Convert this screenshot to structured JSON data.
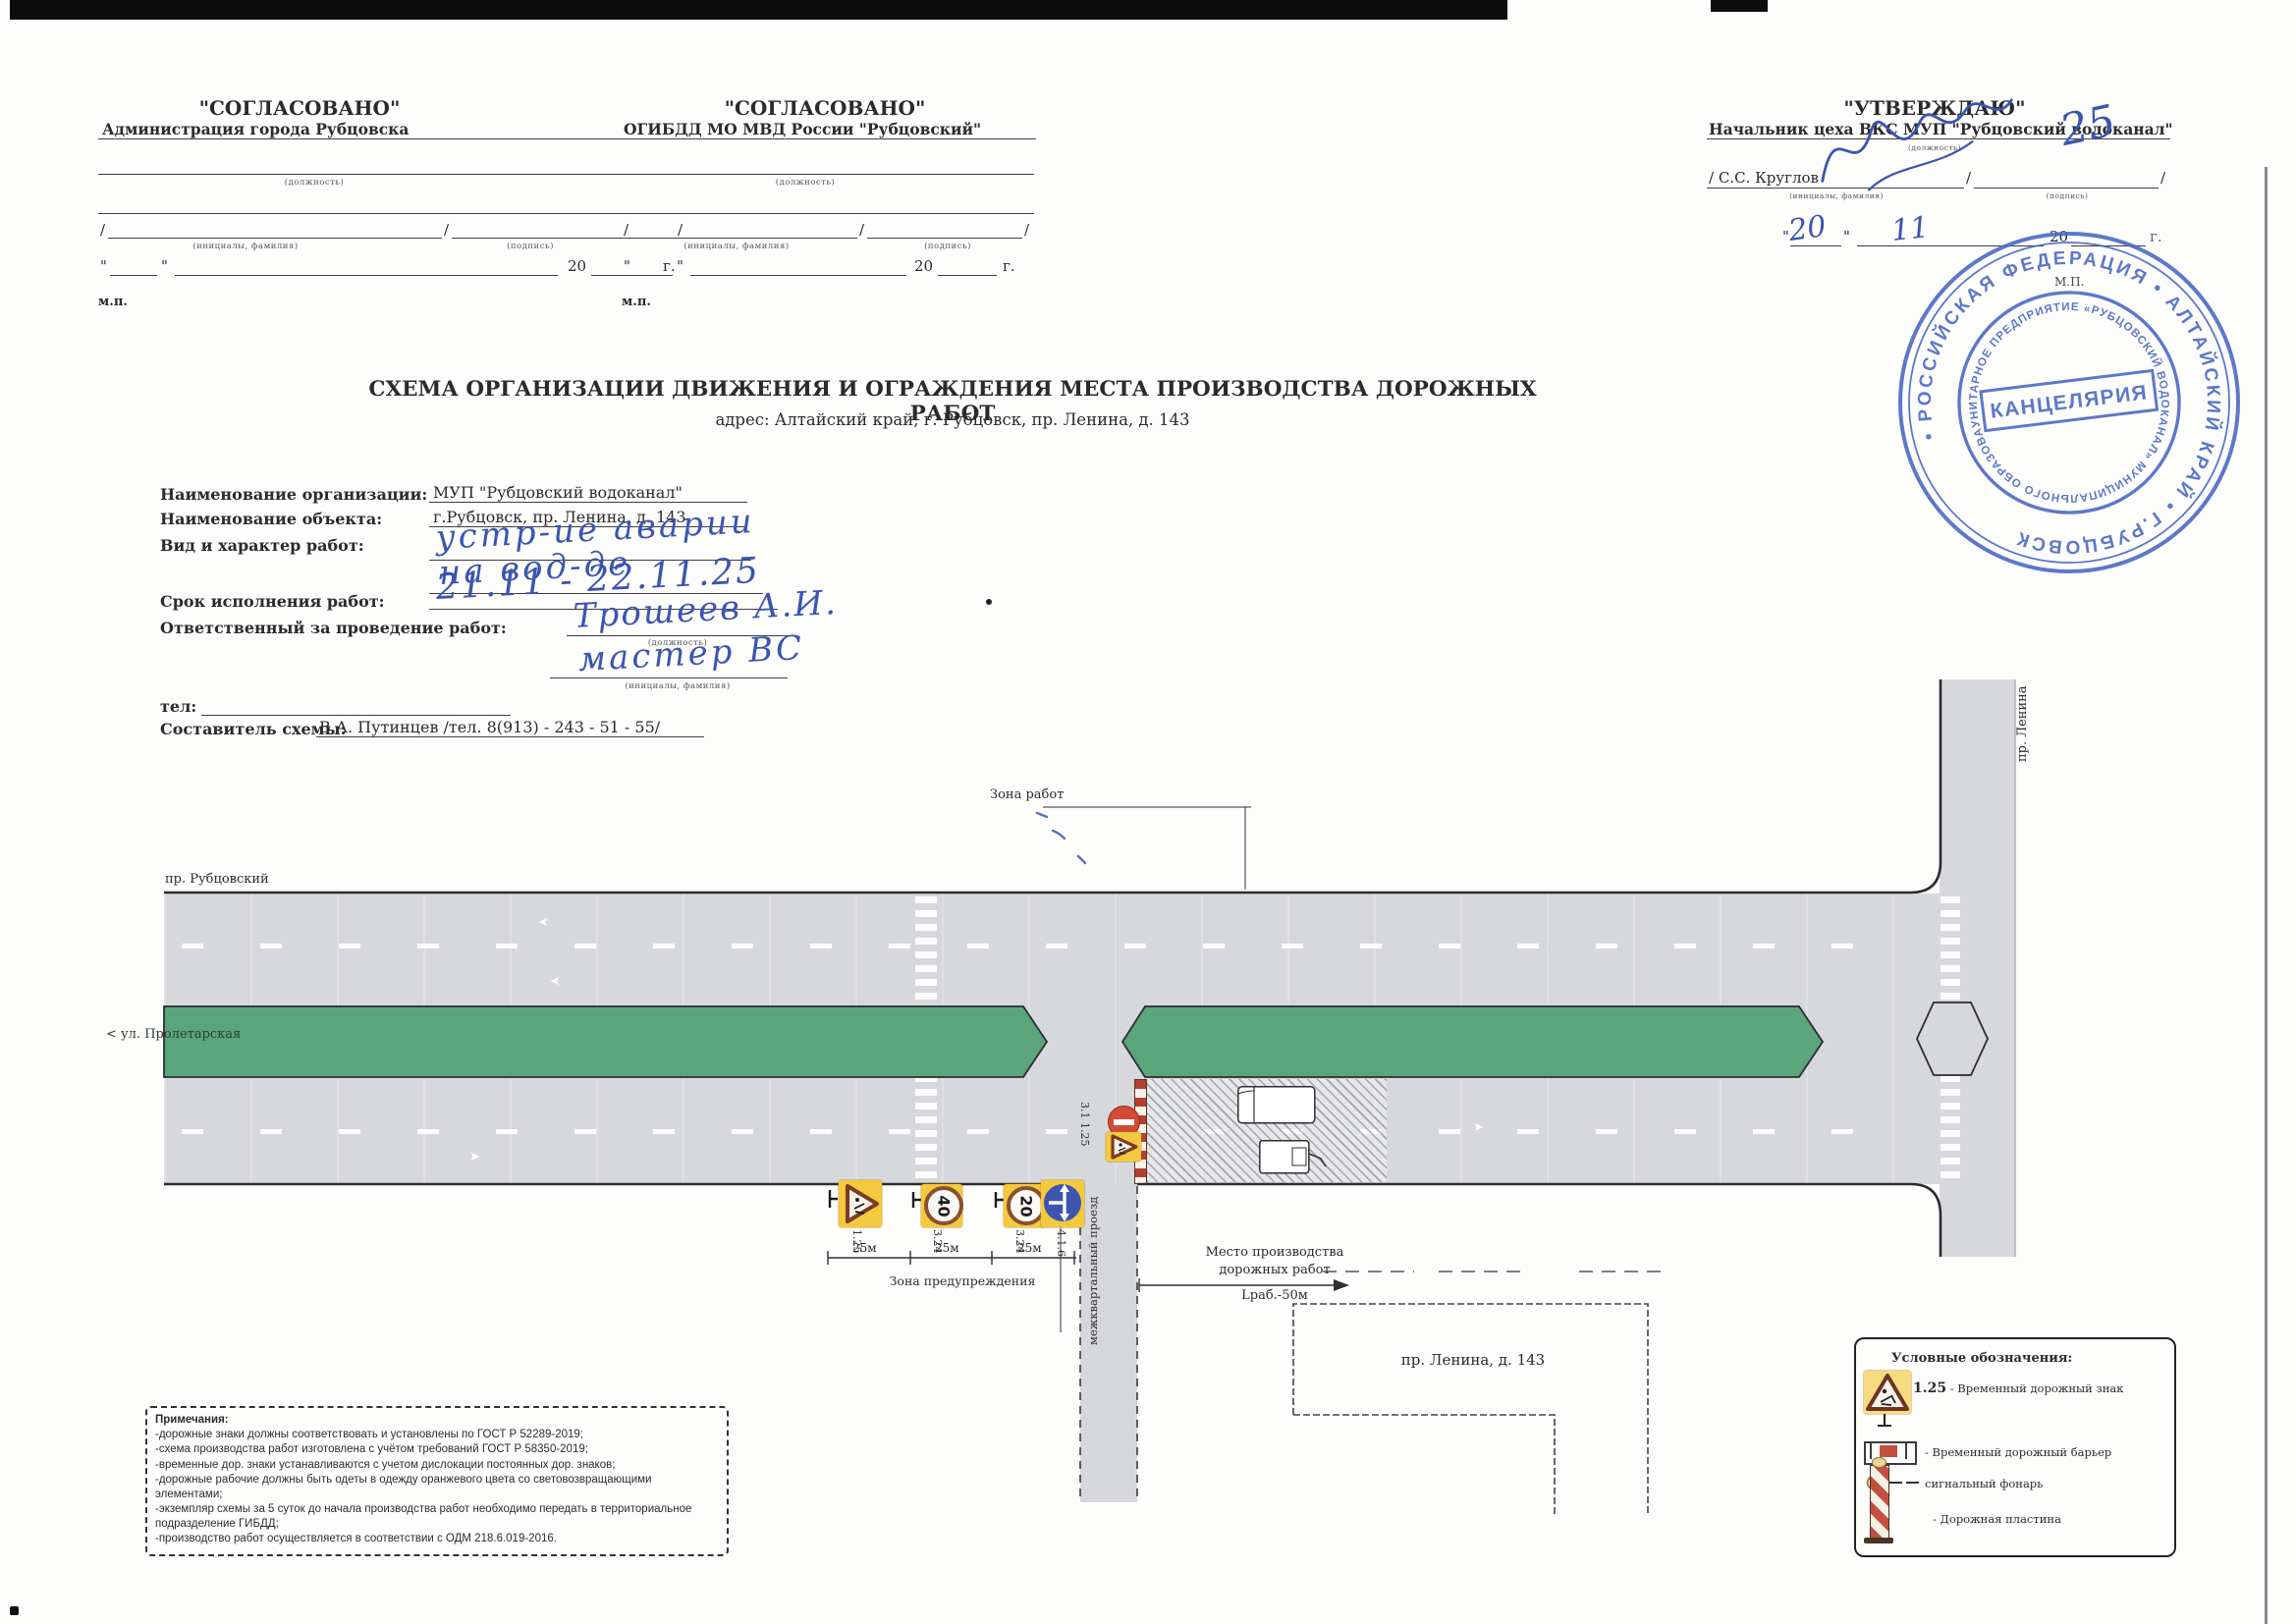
{
  "colors": {
    "road_gray": "#d7d8dc",
    "median_green": "#5aa57b",
    "sign_yellow": "#f3c93f",
    "barrier_red": "#b3402f",
    "sign_blue": "#3d55ae",
    "pen_blue": "#3b55b0",
    "stamp_blue": "#4866c2"
  },
  "header": {
    "agree1": {
      "title": "\"СОГЛАСОВАНО\"",
      "org": "Администрация города Рубцовска",
      "position_label": "(должность)",
      "name_label": "(инициалы, фамилия)",
      "sign_label": "(подпись)",
      "slash": "/",
      "quote": "\"",
      "year": "20",
      "year_suffix": "г.",
      "mp": "м.п."
    },
    "agree2": {
      "title": "\"СОГЛАСОВАНО\"",
      "org": "ОГИБДД МО МВД России \"Рубцовский\"",
      "position_label": "(должность)",
      "name_label": "(инициалы, фамилия)",
      "sign_label": "(подпись)",
      "slash": "/",
      "quote": "\"",
      "year": "20",
      "year_suffix": "г.",
      "mp": "м.п."
    },
    "approve": {
      "title": "\"УТВЕРЖДАЮ\"",
      "org": "Начальник цеха ВКС МУП \"Рубцовский водоканал\"",
      "position_label": "(должность)",
      "name_printed": "/  С.С. Круглов",
      "name_label": "(инициалы, фамилия)",
      "sign_label": "(подпись)",
      "slash": "/",
      "quote": "\"",
      "day_hand": "20",
      "month_hand": "11",
      "year_printed": "20",
      "year_hand": "25",
      "year_suffix": "г.",
      "mp": "М.П."
    }
  },
  "doc": {
    "title": "СХЕМА ОРГАНИЗАЦИИ ДВИЖЕНИЯ И ОГРАЖДЕНИЯ МЕСТА  ПРОИЗВОДСТВА ДОРОЖНЫХ РАБОТ",
    "address": "адрес: Алтайский край, г. Рубцовск, пр. Ленина, д. 143"
  },
  "info": {
    "org_label": "Наименование организации:",
    "org_value": "МУП \"Рубцовский водоканал\"",
    "object_label": "Наименование объекта:",
    "object_value": "г.Рубцовск, пр. Ленина, д. 143",
    "work_type_label": "Вид и характер работ:",
    "work_type_hand1": "устр-ие аварии",
    "work_type_hand2": "на вод-де",
    "term_label": "Срок исполнения работ:",
    "term_hand": "21.11 - 22.11.25",
    "resp_label": "Ответственный за проведение работ:",
    "resp_hand": "Трошеев А.И.",
    "resp_pos_label": "(должность)",
    "resp_pos_hand": "мастер ВС",
    "resp_name_label": "(инициалы, фамилия)",
    "tel_label": "тел:",
    "author_label": "Составитель схемы:",
    "author_value": "В.А. Путинцев /тел. 8(913) - 243 - 51 - 55/"
  },
  "diagram": {
    "work_zone_label": "Зона работ",
    "street_top": "пр. Рубцовский",
    "street_left": "< ул. Пролетарская",
    "street_right": "пр. Ленина",
    "driveway_label": "межквартальный проезд",
    "warning_zone_label": "Зона предупреждения",
    "dist1": "25м",
    "dist2": "25м",
    "dist3": "25м",
    "work_place_line1": "Место производства",
    "work_place_line2": "дорожных работ",
    "work_length": "Lраб.-50м",
    "building_label": "пр. Ленина, д. 143",
    "sign_road_label": "3.1 1.25",
    "sign1_label": "1.25",
    "sign2_label": "3.24",
    "sign2_value": "40",
    "sign3_label": "3.24",
    "sign3_value": "20",
    "sign4_label": "4.1.6"
  },
  "legend": {
    "title": "Условные обозначения:",
    "item1_code": "1.25",
    "item1_text": "- Временный дорожный знак",
    "item2_text": "- Временный дорожный барьер",
    "item3_text": "сигнальный фонарь",
    "item4_text": "- Дорожная пластина"
  },
  "notes": {
    "title": "Примечания:",
    "lines": [
      "-дорожные знаки должны соответствовать и установлены по ГОСТ Р 52289-2019;",
      "-схема производства работ изготовлена с учётом требований ГОСТ Р 58350-2019;",
      "-временные дор. знаки устанавливаются с учетом дислокации постоянных дор. знаков;",
      "-дорожные рабочие должны быть одеты в одежду оранжевого цвета со световозвращающими элементами;",
      "-экземпляр схемы за 5 суток до начала производства работ необходимо передать в территориальное подразделение ГИБДД;",
      "-производство работ осуществляется в соответствии с ОДМ 218.6.019-2016."
    ]
  },
  "stamp": {
    "ring_outer": "• РОССИЙСКАЯ ФЕДЕРАЦИЯ • АЛТАЙСКИЙ КРАЙ • Г.РУБЦОВСК ",
    "ring_inner": "УНИТАРНОЕ ПРЕДПРИЯТИЕ «РУБЦОВСКИЙ ВОДОКАНАЛ» МУНИЦИПАЛЬНОГО ОБРАЗОВАНИЯ «ГОРОД РУБЦОВСК»",
    "center": "КАНЦЕЛЯРИЯ"
  }
}
